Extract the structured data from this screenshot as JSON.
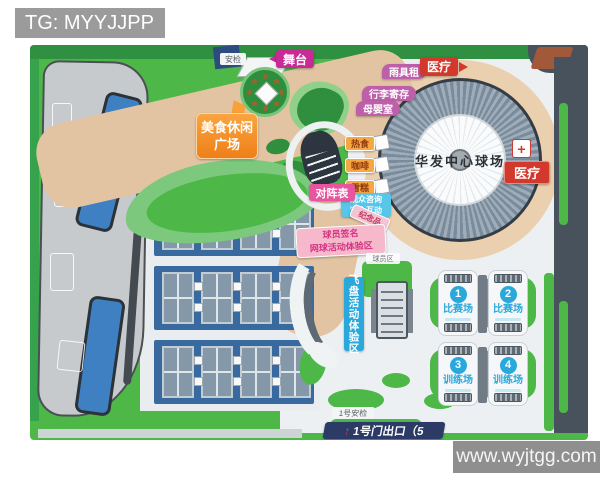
{
  "banner": {
    "text": "TG: MYYJJPP"
  },
  "watermark": {
    "text": "www.wyjtgg.com"
  },
  "map": {
    "stadium_name": "华发中心球场",
    "labels": {
      "stage": "舞台",
      "security_gate": "安检",
      "food_plaza_line1": "美食休闲",
      "food_plaza_line2": "广场",
      "rain_gear_rental": "雨具租",
      "luggage_storage": "行李寄存",
      "nursing_room": "母婴室",
      "medical_top": "医疗",
      "medical_right": "医疗",
      "hot_food": "热食",
      "coffee": "咖啡",
      "ice_cream": "雪糕",
      "audience_info_line1": "观众咨询",
      "audience_info_line2": "观众互动",
      "match_schedule": "对阵表",
      "souvenir": "纪念品",
      "autograph_line1": "球员签名",
      "autograph_line2": "网球活动体验区",
      "player_zone": "球员区",
      "frisbee_zone": "飞盘活动体验区",
      "gate1_security": "1号安检",
      "gate1_exit": "1号门出口（5"
    },
    "icons": {
      "up_arrow": "↑",
      "medical_cross": "+"
    },
    "courts": [
      {
        "number": "1",
        "label": "比赛场"
      },
      {
        "number": "2",
        "label": "比赛场"
      },
      {
        "number": "3",
        "label": "训练场"
      },
      {
        "number": "4",
        "label": "训练场"
      }
    ],
    "colors": {
      "grass_green": "#4db848",
      "plaza_beige": "#e3c4a2",
      "stadium_gray": "#7a8b9b",
      "label_magenta": "#c92a96",
      "label_pink": "#e8559f",
      "label_orange": "#f6921e",
      "label_red": "#d2382c",
      "label_sky_blue": "#29a8dc",
      "court_block_blue": "#38699f",
      "gate_banner_navy": "#2c3a66"
    }
  }
}
